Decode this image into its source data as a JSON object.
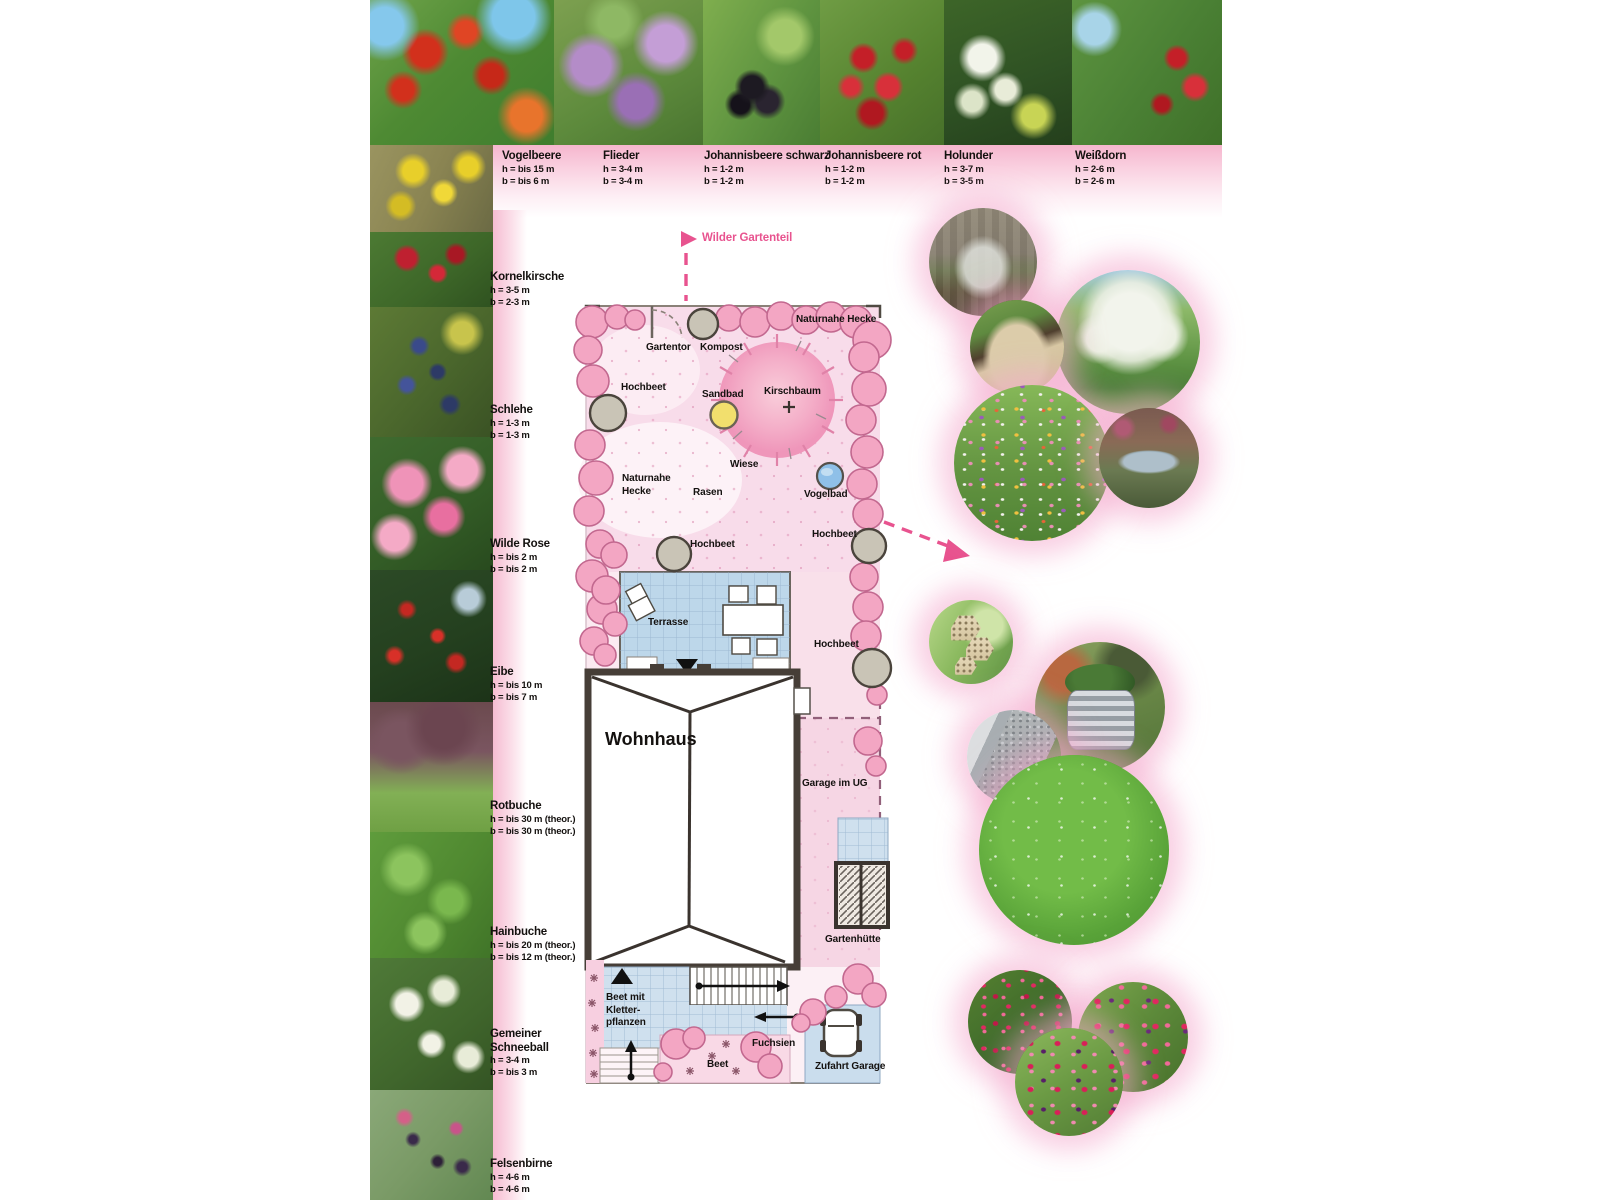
{
  "top_row": {
    "items": [
      {
        "name": "Vogelbeere",
        "h": "h = bis 15 m",
        "b": "b = bis 6 m"
      },
      {
        "name": "Flieder",
        "h": "h = 3-4 m",
        "b": "b = 3-4 m"
      },
      {
        "name": "Johannisbeere schwarz",
        "h": "h = 1-2 m",
        "b": "b = 1-2 m"
      },
      {
        "name": "Johannisbeere rot",
        "h": "h = 1-2 m",
        "b": "b = 1-2 m"
      },
      {
        "name": "Holunder",
        "h": "h = 3-7 m",
        "b": "b = 3-5 m"
      },
      {
        "name": "Weißdorn",
        "h": "h = 2-6 m",
        "b": "b = 2-6 m"
      }
    ]
  },
  "left_column": {
    "items": [
      {
        "name": "Kornelkirsche",
        "h": "h = 3-5 m",
        "b": "b = 2-3 m"
      },
      {
        "name": "Schlehe",
        "h": "h = 1-3 m",
        "b": "b = 1-3 m"
      },
      {
        "name": "Wilde Rose",
        "h": "h = bis 2 m",
        "b": "b = bis 2 m"
      },
      {
        "name": "Eibe",
        "h": "h = bis 10 m",
        "b": "b = bis 7 m"
      },
      {
        "name": "Rotbuche",
        "h": "h = bis 30 m (theor.)",
        "b": "b = bis 30 m (theor.)"
      },
      {
        "name": "Hainbuche",
        "h": "h = bis 20 m (theor.)",
        "b": "b = bis 12 m (theor.)"
      },
      {
        "name": "Gemeiner Schneeball",
        "h": "h = 3-4 m",
        "b": "b = bis 3 m"
      },
      {
        "name": "Felsenbirne",
        "h": "h = 4-6 m",
        "b": "b = 4-6 m"
      }
    ]
  },
  "plan": {
    "callout": "Wilder Gartenteil",
    "labels": {
      "gartentor": "Gartentor",
      "kompost": "Kompost",
      "naturnahe_hecke": "Naturnahe Hecke",
      "naturnahe_hecke_2line": "Naturnahe\nHecke",
      "hochbeet": "Hochbeet",
      "sandbad": "Sandbad",
      "kirschbaum": "Kirschbaum",
      "wiese": "Wiese",
      "rasen": "Rasen",
      "vogelbad": "Vogelbad",
      "terrasse": "Terrasse",
      "wohnhaus": "Wohnhaus",
      "garage_im_ug": "Garage im UG",
      "gartenhuette": "Gartenhütte",
      "beet_kletterpflanzen": "Beet mit\nKletter-\npflanzen",
      "fuchsien": "Fuchsien",
      "beet": "Beet",
      "zufahrt_garage": "Zufahrt Garage"
    }
  },
  "colors": {
    "accent_pink": "#e8538f",
    "hedge_pink": "#f3a6c3",
    "terrace_blue": "#bdd7ea",
    "sand_yellow": "#f2df6d",
    "water_blue": "#8fc0e8",
    "label_black": "#14110f"
  }
}
